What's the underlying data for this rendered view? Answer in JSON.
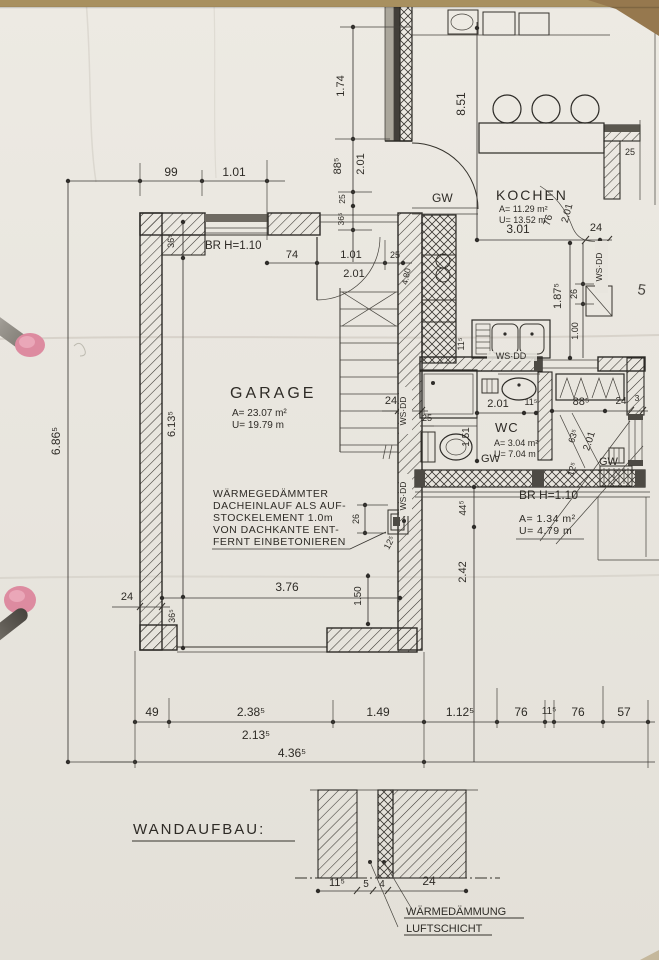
{
  "rooms": {
    "garage": {
      "name": "GARAGE",
      "area": "A= 23.07 m²",
      "perimeter": "U= 19.79 m"
    },
    "kochen": {
      "name": "KOCHEN",
      "area": "A= 11.29 m²",
      "perimeter": "U= 13.52 m"
    },
    "wc": {
      "name": "WC",
      "area": "A= 3.04 m²",
      "perimeter": "U= 7.04 m"
    },
    "storage": {
      "area": "A= 1.34 m²",
      "perimeter": "U= 4.79 m"
    }
  },
  "labels": {
    "gw": "GW",
    "wsdd": "WS·DD",
    "br_height": "BR H=1.10",
    "page_mark": "5"
  },
  "note": {
    "line1": "WÄRMEGEDÄMMTER",
    "line2": "DACHEINLAUF ALS AUF-",
    "line3": "STOCKELEMENT 1.0m",
    "line4": "VON DACHKANTE ENT-",
    "line5": "FERNT EINBETONIEREN"
  },
  "wall_section": {
    "title": "WANDAUFBAU:",
    "insulation": "WÄRMEDÄMMUNG",
    "air_layer": "LUFTSCHICHT"
  },
  "dims": {
    "top99": "99",
    "top101": "1.01",
    "g74": "74",
    "g101": "1.01",
    "g25": "25",
    "g201": "2.01",
    "v174": "1.74",
    "v885": "88⁵",
    "v201": "2.01",
    "v25": "25",
    "v365": "36⁵",
    "k851": "8.51",
    "k301": "3.01",
    "k76": "76",
    "k201": "2.01",
    "k24": "24",
    "k1875": "1.87⁵",
    "k26": "26",
    "k100": "1.00",
    "k115": "11⁵",
    "wc201": "2.01",
    "wc115": "11⁵",
    "wc885": "88⁵",
    "wc24": "24",
    "wc3": "3",
    "wc151": "1.51",
    "wc25": "25",
    "d635": "63⁵",
    "d201": "2.01",
    "d125": "12⁵",
    "v445": "44⁵",
    "v242": "2.42",
    "ga6135": "6.13⁵",
    "ga365": "36⁵",
    "ga376": "3.76",
    "ga150": "1.50",
    "ga24": "24",
    "ga26": "26",
    "ga125": "12⁵",
    "ga480": "4.80",
    "gc24": "24",
    "b49": "49",
    "b2385": "2.38⁵",
    "b149": "1.49",
    "b1125": "1.12⁵",
    "b76": "76",
    "b115": "11⁵",
    "b57": "57",
    "b2135": "2.13⁵",
    "b4365": "4.36⁵",
    "total": "6.86⁵",
    "ws115": "11⁵",
    "ws5": "5",
    "ws4": "4",
    "ws24": "24"
  }
}
